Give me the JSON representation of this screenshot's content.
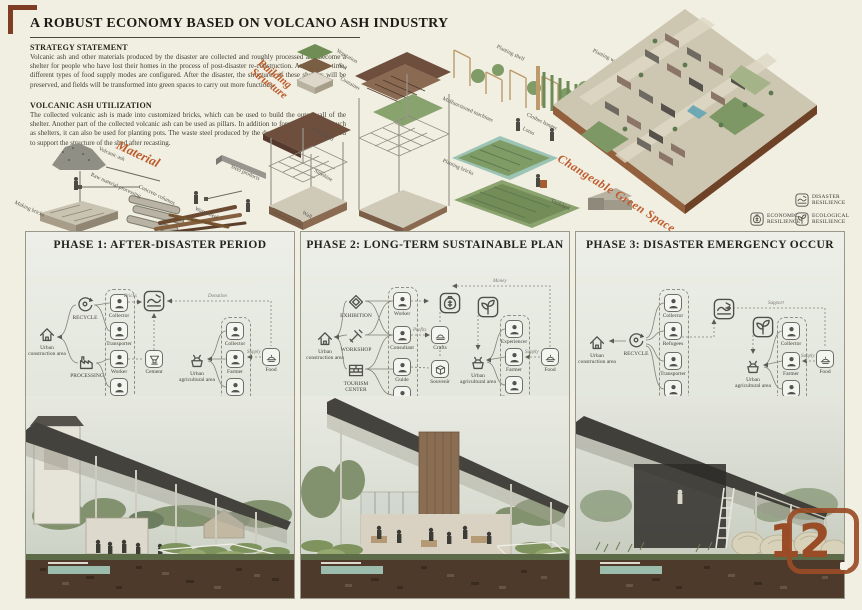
{
  "title": "A ROBUST ECONOMY BASED ON VOLCANO ASH INDUSTRY",
  "sections": {
    "strategy": {
      "heading": "STRATEGY STATEMENT",
      "body": "Volcanic ash and other materials produced by the disaster are collected and roughly processed and become a shelter for people who have lost their homes in the process of post-disaster re-construction. At the same time, different types of food supply modes are configured. After the disaster, the structures of these shelters will be preserved, and fields will be transformed into green spaces to carry out more functions."
    },
    "utilization": {
      "heading": "VOLCANIC ASH UTILIZATION",
      "body": "The collected volcanic ash is made into customized bricks, which can be used to build the outer wall of the shelter. Another part of the collected volcanic ash can be used as pillars. In addition to forming structures such as shelters, it can also be used for planting pots. The waste steel produced by the destroyed houses can be used to support the structure of the shed after recasting."
    }
  },
  "material": {
    "title": "Material",
    "labels": [
      "Volcanic ash",
      "Raw material processing",
      "Concrete columns",
      "Making bricks",
      "Waste steel",
      "Steel products"
    ]
  },
  "building": {
    "title_line1": "Building",
    "title_line2": "Structure",
    "labels": [
      "Vegetation",
      "Soil",
      "Container",
      "Waterhead",
      "Sunshine",
      "Wall"
    ]
  },
  "green": {
    "title": "Changeable Green Space",
    "labels": [
      "Planting shelf",
      "Planting wall",
      "Malfunctioned machines",
      "Clothes hanger",
      "Lotus",
      "Planting bricks",
      "Toolshed"
    ]
  },
  "legend": [
    {
      "line1": "DISASTER",
      "line2": "RESILIENCE"
    },
    {
      "line1": "ECONOMIC",
      "line2": "RESILIENCE"
    },
    {
      "line1": "ECOLOGICAL",
      "line2": "RESILIENCE"
    }
  ],
  "phases": [
    {
      "title": "PHASE 1: AFTER-DISASTER PERIOD",
      "left_area": "Urban construction area",
      "groups": [
        "RECYCLE",
        "PROCESSING"
      ],
      "roles": [
        "Collector",
        "Transporter",
        "Worker",
        "Operator"
      ],
      "center_node": "Cement",
      "right_area": "Urban agricultural area",
      "right_roles": [
        "Collector",
        "Farmer",
        "Transporter"
      ],
      "food": "Food",
      "flows": {
        "a": "Bricks",
        "b": "Donation",
        "c": "Supply"
      }
    },
    {
      "title": "PHASE 2: LONG-TERM SUSTAINABLE PLAN",
      "left_area": "Urban construction area",
      "groups": [
        "EXHIBITION",
        "WORKSHOP",
        "TOURISM CENTER"
      ],
      "roles": [
        "Worker",
        "Consultant",
        "Guide",
        "Servicer"
      ],
      "products": [
        "Crafts",
        "Souvenir"
      ],
      "right_area": "Urban agricultural area",
      "right_roles": [
        "Experiencer",
        "Farmer",
        "Transporter"
      ],
      "food": "Food",
      "flows": {
        "a": "Money",
        "b": "Profits",
        "c": "Supply"
      }
    },
    {
      "title": "PHASE 3: DISASTER EMERGENCY OCCUR",
      "left_area": "Urban construction area",
      "groups": [
        "RECYCLE"
      ],
      "roles": [
        "Collector",
        "Refugees",
        "Transporter",
        "Worker"
      ],
      "right_area": "Urban agricultural area",
      "right_roles": [
        "Collector",
        "Farmer",
        "Transporter"
      ],
      "food": "Food",
      "flows": {
        "a": "Support",
        "b": "Supply"
      }
    }
  ],
  "logo": {
    "number": "12"
  }
}
